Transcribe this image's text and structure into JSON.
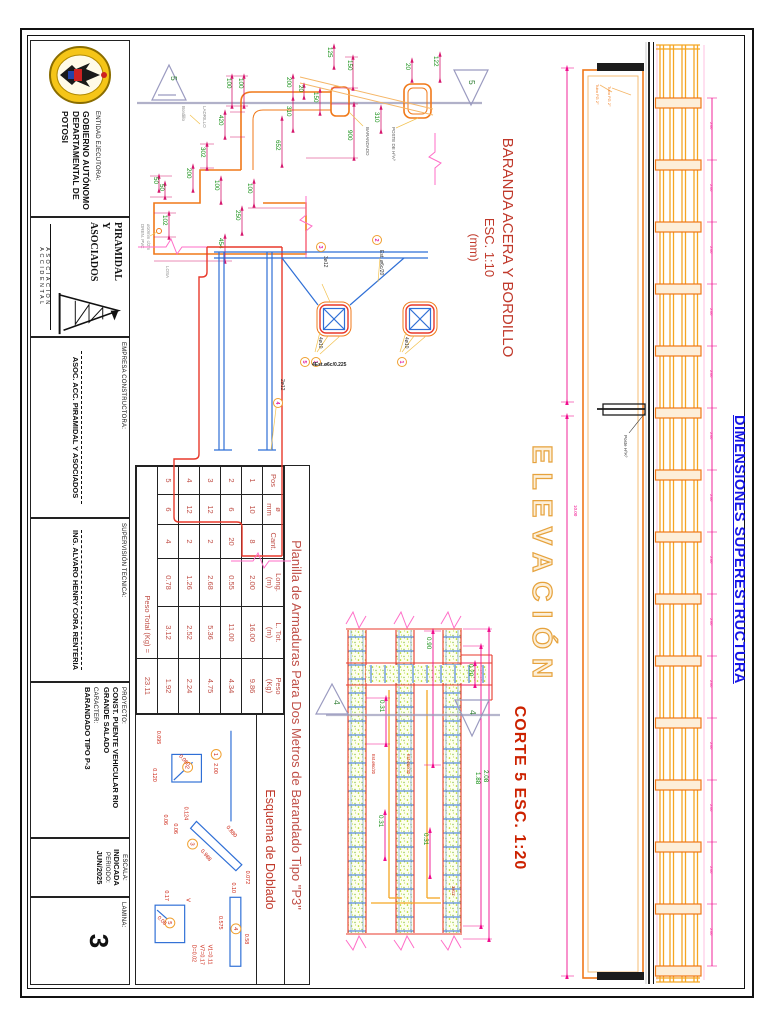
{
  "titleblock": {
    "entidad_label": "ENTIDAD EJECUTORA:",
    "entidad1": "GOBIERNO AUTÓNOMO",
    "entidad2": "DEPARTAMENTAL DE",
    "entidad3": "POTOSI",
    "logo2_line1": "PIRAMIDAL",
    "logo2_line2": "Y ASOCIADOS",
    "logo2_sub": "ASOCIACION  ACCIDENTAL",
    "empresa_label": "EMPRESA CONSTRUCTORA:",
    "empresa": "ASOC. ACC. PIRAMIDAL Y ASOCIADOS",
    "supervision_label": "SUPERVISIÓN TECNICA:",
    "supervision": "ING. ALVARO HENRY CORA RENTERIA",
    "proyecto_label": "PROYECTO:",
    "proyecto1": "CONST. PUENTE VEHICULAR RIO",
    "proyecto2": "GRANDE SALADO",
    "caracter_label": "CARACTER:",
    "caracter": "BARANDADO TIPO P-3",
    "escala_label": "ESCALA:",
    "escala": "INDICADA",
    "periodo_label": "PERIODO:",
    "periodo": "JUN/2025",
    "lamina_label": "LAMINA:",
    "lamina": "3"
  },
  "dimensiones": "DIMENSIONES SUPERESTRUCTURA",
  "baranda": {
    "title": "BARANDA ACERA Y BORDILLO",
    "scale": "ESC. 1:10",
    "units": "(mm)",
    "marker": "5",
    "dims": [
      "125",
      "150",
      "100",
      "100",
      "20",
      "200",
      "310",
      "150",
      "310",
      "20",
      "122",
      "900",
      "652",
      "420",
      "302",
      "200",
      "100",
      "100",
      "50",
      "50",
      "102",
      "250",
      "454"
    ],
    "labels": [
      "LADRILLO",
      "Bordillo",
      "BARANDADO",
      "POSTE DE HºAº",
      "DREN. PVC",
      "ø10mm c/2m",
      "LOSA"
    ]
  },
  "armadura": {
    "labels": [
      "3ø12",
      "Est. ø6c/20",
      "4ø10",
      "4ø10",
      "4Est.ø6c/0.225",
      "2ø12"
    ],
    "pos": [
      "3",
      "2",
      "1",
      "1",
      "5",
      "4"
    ]
  },
  "corte": {
    "title": "CORTE 5 ESC. 1:20",
    "marker": "4",
    "dims": [
      "0.90",
      "0.20",
      "2.08",
      "1.88",
      "0.31",
      "0.31",
      "0.31"
    ],
    "bars": [
      "Est.ø6c/20",
      "Est.ø6c/20",
      "3ø12"
    ]
  },
  "elevacion": {
    "title": "ELEVACIÓN",
    "overall": "10.00",
    "post_spacing": "2.00",
    "leaders": [
      "Tubo FG 2\"",
      "Tubo FG 2\"",
      "Poste HºAº"
    ]
  },
  "planilla": {
    "title": "Planilla de Armaduras Para Dos Metros de Barandado Tipo \"P3\"",
    "header_l1": [
      "Pos",
      "ø",
      "Cant.",
      "Long.",
      "L. Tot.",
      "Peso"
    ],
    "header_l2": [
      "",
      "mm",
      "",
      "(m)",
      "(m)",
      "(Kg)"
    ],
    "rows": [
      [
        "1",
        "10",
        "8",
        "2.00",
        "16.00",
        "9.86"
      ],
      [
        "2",
        "6",
        "20",
        "0.55",
        "11.00",
        "4.34"
      ],
      [
        "3",
        "12",
        "2",
        "2.68",
        "5.36",
        "4.75"
      ],
      [
        "4",
        "12",
        "2",
        "1.26",
        "2.52",
        "2.24"
      ],
      [
        "5",
        "6",
        "4",
        "0.78",
        "3.12",
        "1.92"
      ]
    ],
    "total_label": "Peso Total (Kg) =",
    "total": "23.11"
  },
  "esquema": {
    "title": "Esquema de Doblado",
    "s1": {
      "n": "1",
      "len": "2.00"
    },
    "s2": {
      "n": "2",
      "a": "0.095",
      "b": "0.120",
      "c": "0.060"
    },
    "s3": {
      "n": "3",
      "top": "0.880",
      "bot": "0.988",
      "l1": "0.124",
      "l2": "0.06",
      "l3": "0.06",
      "r": "0.072"
    },
    "s4": {
      "n": "4",
      "a": "0.10",
      "b": "0.58",
      "c": "0.575"
    },
    "s5": {
      "n": "5",
      "v": "V",
      "a": "0.17",
      "b": "0.08",
      "note1": "V1=0.11",
      "note2": "V7=0.17",
      "note3": "D=0.02"
    }
  }
}
